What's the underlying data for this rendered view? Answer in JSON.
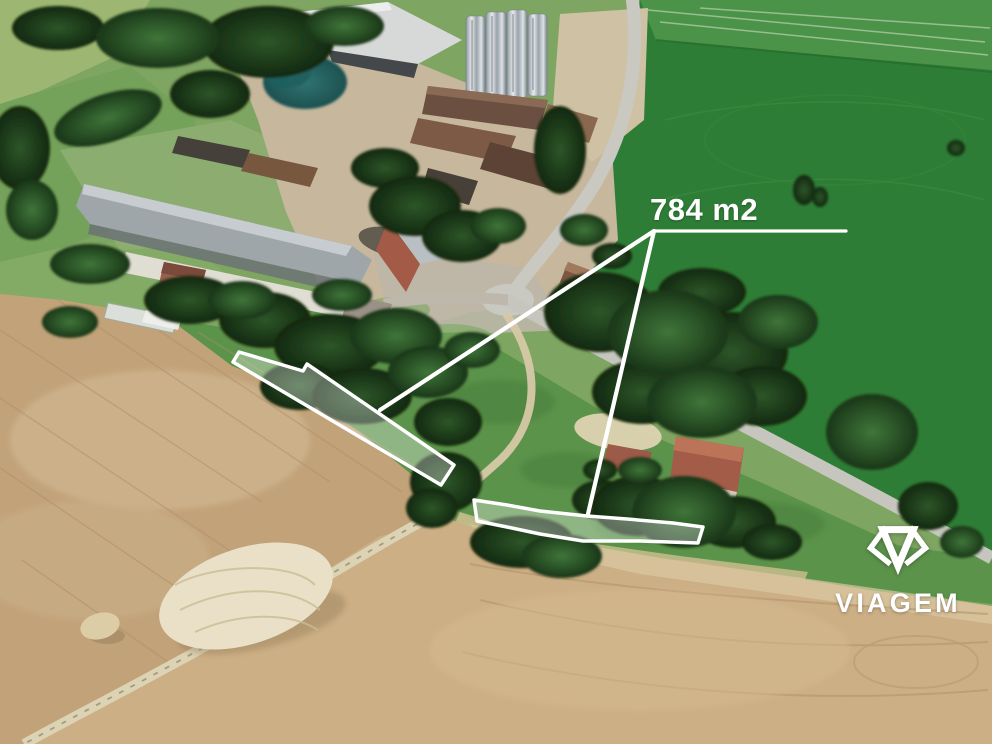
{
  "meta": {
    "type": "aerial-property-listing-photo",
    "description": "Oblique 3D aerial photo of a farm village with two land parcels outlined in white"
  },
  "annotation": {
    "area_label": "784 m2",
    "overlay_color": "#ffffff",
    "parcels": [
      {
        "name": "upper-strip-parcel"
      },
      {
        "name": "lower-curved-parcel"
      }
    ]
  },
  "watermark": {
    "brand_text": "VIAGEM",
    "icon": "diamond-gem-icon",
    "color": "#ffffff"
  },
  "scene_features": [
    "farm buildings with gray and brown roofs",
    "grain silos",
    "village road junction",
    "bright green field",
    "harvested tan fields",
    "tree clusters",
    "straw pile",
    "dirt track"
  ],
  "palette": {
    "field_green_bright": "#2e7d36",
    "field_green_light": "#9db773",
    "grass_green": "#5c934b",
    "tree_green_dark": "#1a3618",
    "teal_tree": "#2a6f6e",
    "soil_tan": "#c2a279",
    "soil_light": "#dcd2b4",
    "road_gray": "#c9c9c2",
    "barn_roof_gray": "#9ea6aa",
    "barn_roof_brown": "#7b5743",
    "roof_red": "#a35c48",
    "silo_gray": "#b9bfc4",
    "overlay_white": "#ffffff"
  }
}
